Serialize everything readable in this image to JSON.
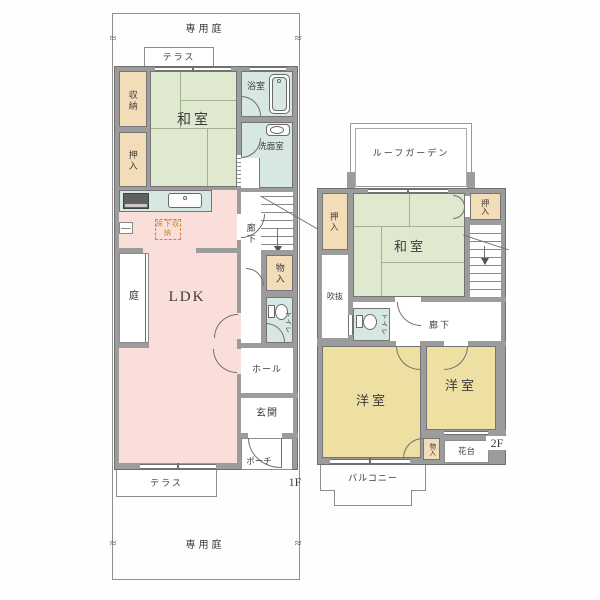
{
  "colors": {
    "wall": "#9c9c9c",
    "tatami": "#dfe9d0",
    "closet_tan": "#f3dcb8",
    "ldk_pink": "#f9ded9",
    "water_teal": "#d7e8e2",
    "western_yellow": "#eedfa2",
    "underfloor_accent": "#c8863c"
  },
  "marks": {
    "break": "≈"
  },
  "f1": {
    "floor_label": "1F",
    "garden_top": "専用庭",
    "garden_bottom": "専用庭",
    "terrace_top": "テラス",
    "terrace_bottom": "テラス",
    "storage": "収納",
    "oshiire": "押入",
    "washitsu": "和室",
    "bath": "浴室",
    "washroom": "洗面室",
    "ldk": "LDK",
    "underfloor_storage": "床下収納",
    "garden_side": "庭",
    "corridor": "廊下",
    "monoire": "物入",
    "toilet": "トイレ",
    "hall": "ホール",
    "entrance": "玄関",
    "porch": "ポーチ"
  },
  "f2": {
    "floor_label": "2F",
    "roof_garden": "ルーフガーデン",
    "oshiire_left": "押入",
    "oshiire_right": "押入",
    "washitsu": "和室",
    "void_space": "吹抜",
    "toilet": "トイレ",
    "corridor": "廊下",
    "western_large": "洋室",
    "western_small": "洋室",
    "monoire": "物入",
    "flower_stand": "花台",
    "balcony": "バルコニー"
  }
}
